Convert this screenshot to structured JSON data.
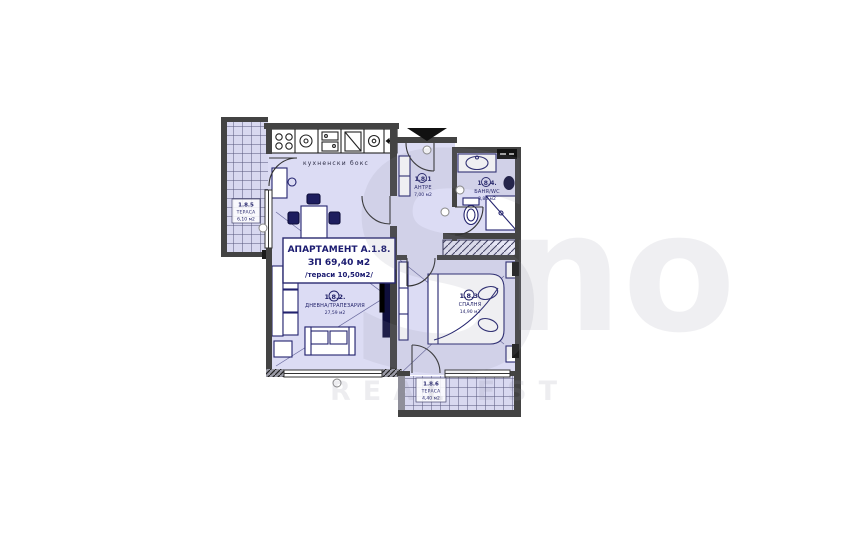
{
  "watermark": {
    "letter_s": "S",
    "letters_no": "no",
    "subtitle": "REAL EST"
  },
  "plan": {
    "kitchen_label": "кухненски бокс",
    "info_box": {
      "line1": "АПАРТАМЕНТ А.1.8.",
      "line2": "ЗП 69,40 м2",
      "line3": "/тераси 10,50м2/"
    },
    "rooms": {
      "entry": {
        "id": "1.8.1",
        "name": "АНТРЕ",
        "area": "7,00 м2"
      },
      "living": {
        "id": "1.8.2.",
        "name": "ДНЕВНА/ТРАПЕЗАРИЯ",
        "area": "27,59 м2"
      },
      "bedroom": {
        "id": "1.8.3.",
        "name": "СПАЛНЯ",
        "area": "14,90 м2"
      },
      "bath": {
        "id": "1.8.4.",
        "name": "БАНЯ/WC",
        "area": "3,80 м2"
      },
      "terrace_left": {
        "id": "1.8.5",
        "name": "ТЕРАСА",
        "area": "6,10 м2"
      },
      "terrace_bottom": {
        "id": "1.8.6",
        "name": "ТЕРАСА",
        "area": "4,40 м2"
      }
    },
    "colors": {
      "room_fill": "#dcdcf4",
      "terrace_fill": "#d8d8f0",
      "wall": "#434343",
      "furniture": "#23236e",
      "label": "#1d1d66"
    }
  }
}
